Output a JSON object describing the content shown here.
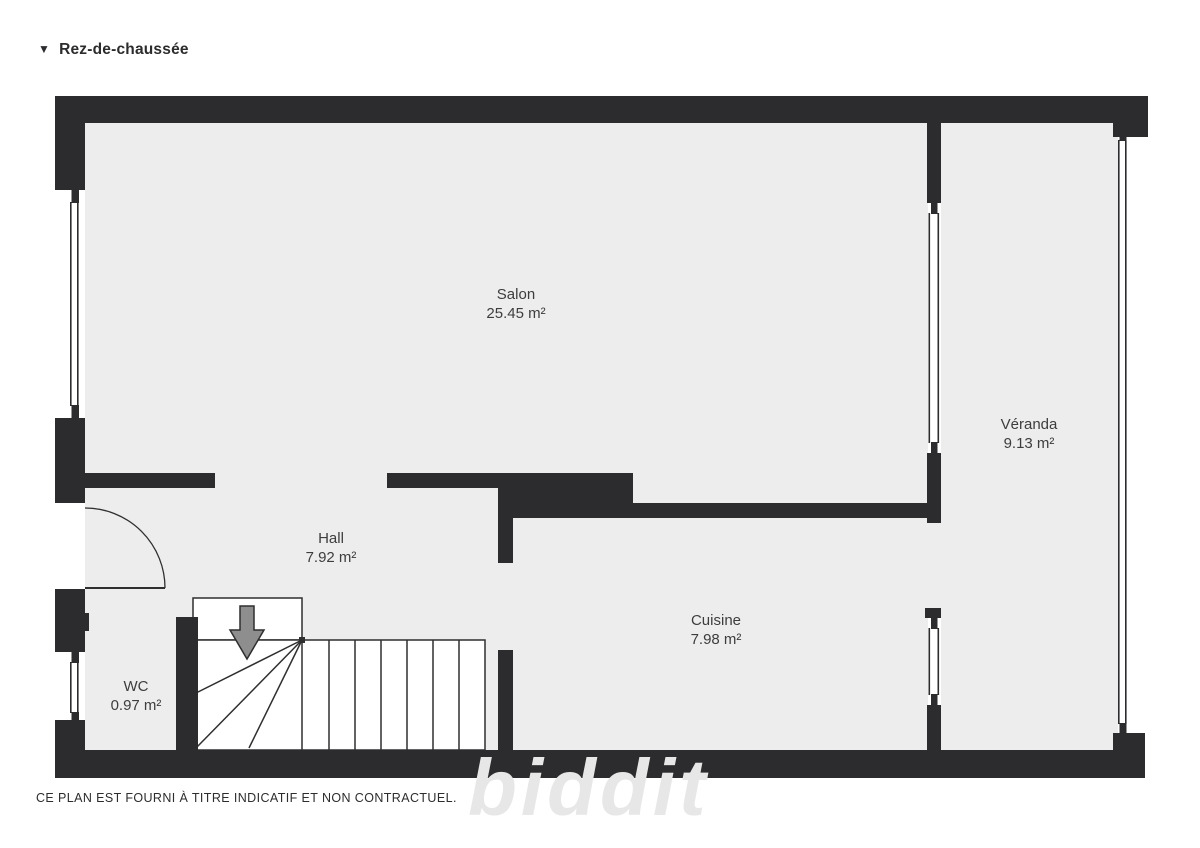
{
  "header": {
    "collapse_icon": "▼",
    "title": "Rez-de-chaussée"
  },
  "rooms": [
    {
      "id": "salon",
      "name": "Salon",
      "area": "25.45 m²"
    },
    {
      "id": "veranda",
      "name": "Véranda",
      "area": "9.13 m²"
    },
    {
      "id": "hall",
      "name": "Hall",
      "area": "7.92 m²"
    },
    {
      "id": "cuisine",
      "name": "Cuisine",
      "area": "7.98 m²"
    },
    {
      "id": "wc",
      "name": "WC",
      "area": "0.97 m²"
    }
  ],
  "watermark": "biddit",
  "footer": {
    "disclaimer": "CE PLAN EST FOURNI À TITRE INDICATIF ET NON CONTRACTUEL."
  },
  "colors": {
    "wall": "#2c2c2e",
    "floor": "#ededed",
    "label_text": "#3d3d3d",
    "arrow_fill": "#8e8e8e"
  }
}
